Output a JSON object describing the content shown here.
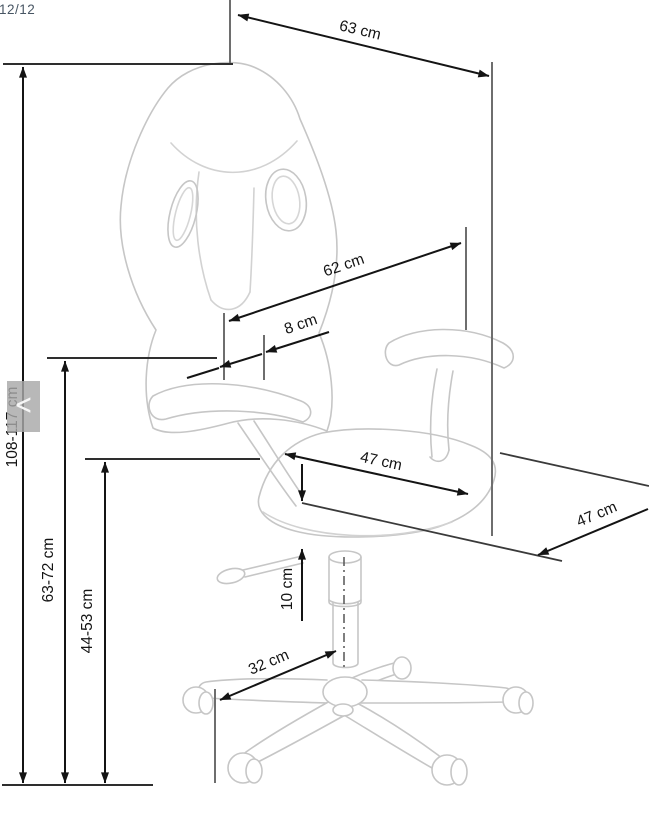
{
  "viewer": {
    "counter": "12/12",
    "prev_label": "<"
  },
  "labels": {
    "total_height": "108-117 cm",
    "backrest_to_floor": "63-72 cm",
    "seat_to_floor": "44-53 cm",
    "overall_width_top": "63 cm",
    "backrest_length": "62 cm",
    "armrest_offset": "8 cm",
    "seat_depth": "47 cm",
    "seat_width": "47 cm",
    "gas_lift_travel": "10 cm",
    "base_leg_span": "32 cm"
  }
}
